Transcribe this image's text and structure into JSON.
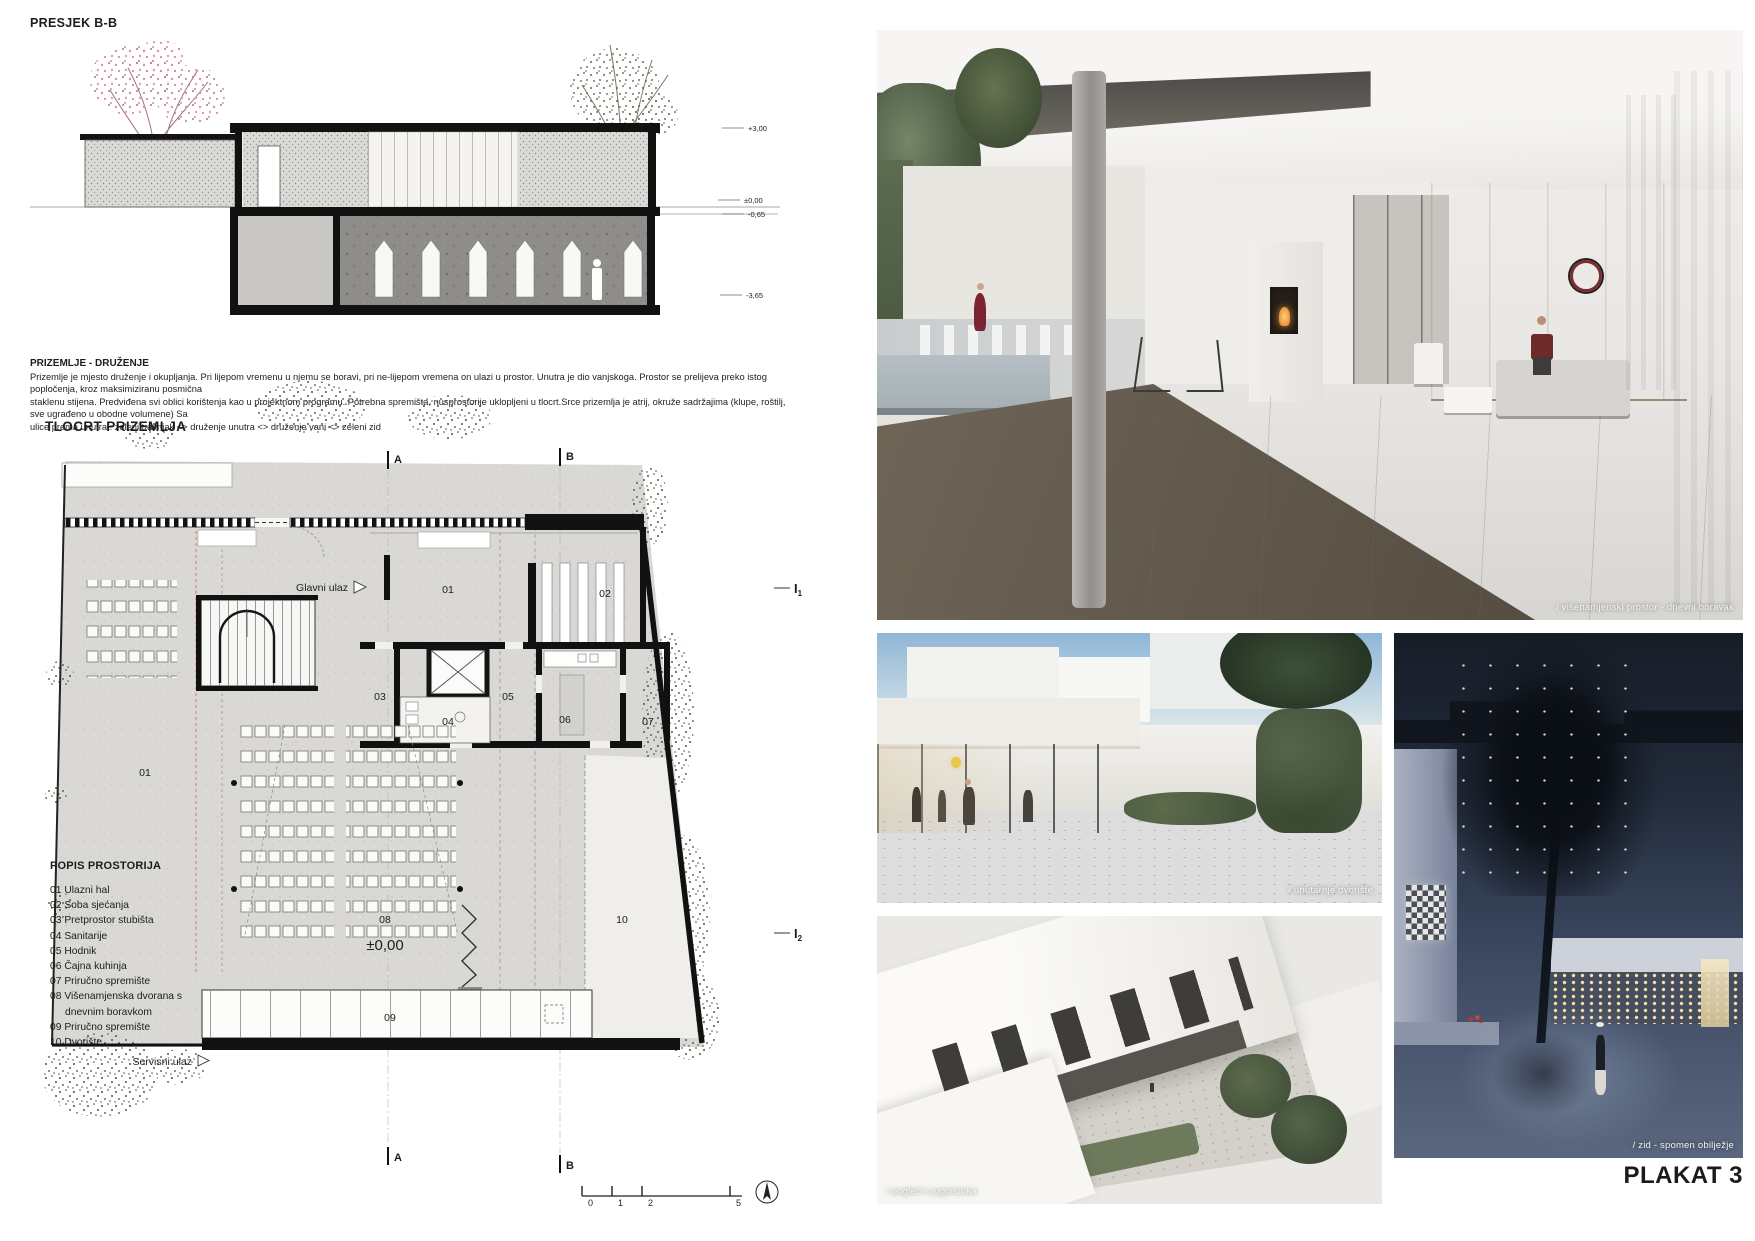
{
  "section": {
    "title": "PRESJEK B-B",
    "levels": [
      "+3,00",
      "±0,00",
      "-0,65",
      "-3,65"
    ]
  },
  "intro": {
    "heading": "PRIZEMLJE - DRUŽENJE",
    "line1": "Prizemlje je mjesto druženje i okupljanja. Pri lijepom vremenu u njemu se boravi, pri ne-lijepom vremena on ulazi u prostor. Unutra je dio vanjskoga. Prostor se prelijeva preko istog popločenja, kroz maksimiziranu posmična",
    "line2": "staklenu stijena. Predviđena svi oblici korištenja kao u projektnom programu. Potrebna spremišta, nusprostorije uklopljeni u tlocrt.Srce prizemlja je atrij, okruže sadržajima (klupe, roštilj, sve ugrađeno u obodne volumene) Sa",
    "line3": "ulice prema unutra : zeleni travnjak  <>  druženje unutra  <>  druženje vani  <>  zeleni zid"
  },
  "plan": {
    "title": "TLOCRT PRIZEMLJA",
    "entrance_main": "Glavni ulaz",
    "entrance_service": "Servisni ulaz",
    "level_mark": "±0,00",
    "rooms": {
      "r01a": "01",
      "r01b": "01",
      "r02": "02",
      "r03": "03",
      "r04": "04",
      "r05": "05",
      "r06": "06",
      "r07": "07",
      "r08": "08",
      "r09": "09",
      "r10": "10"
    },
    "markers": {
      "a": "A",
      "b": "B",
      "i": "I",
      "i1_sub": "1",
      "i2_sub": "2"
    },
    "scale_ticks": [
      "0",
      "1",
      "2",
      "5"
    ]
  },
  "room_list": {
    "title": "POPIS PROSTORIJA",
    "items": [
      "01 Ulazni hal",
      "02 Soba sjećanja",
      "03 Pretprostor stubišta",
      "04 Sanitarije",
      "05 Hodnik",
      "06 Čajna kuhinja",
      "07 Priručno spremište",
      "08 Višenamjenska dvorana s",
      "dnevnim boravkom",
      "09 Priručno spremište",
      "10 Dvorište"
    ]
  },
  "renders": {
    "main_caption": "/ višenamjenski prostor - dnevni boravak",
    "courtyard_caption": "/ unutarnje dvorište",
    "aerial_caption": "/ pogled s jugoistoka",
    "night_caption": "/ zid - spomen obilježje"
  },
  "footer": {
    "poster": "PLAKAT 3"
  }
}
